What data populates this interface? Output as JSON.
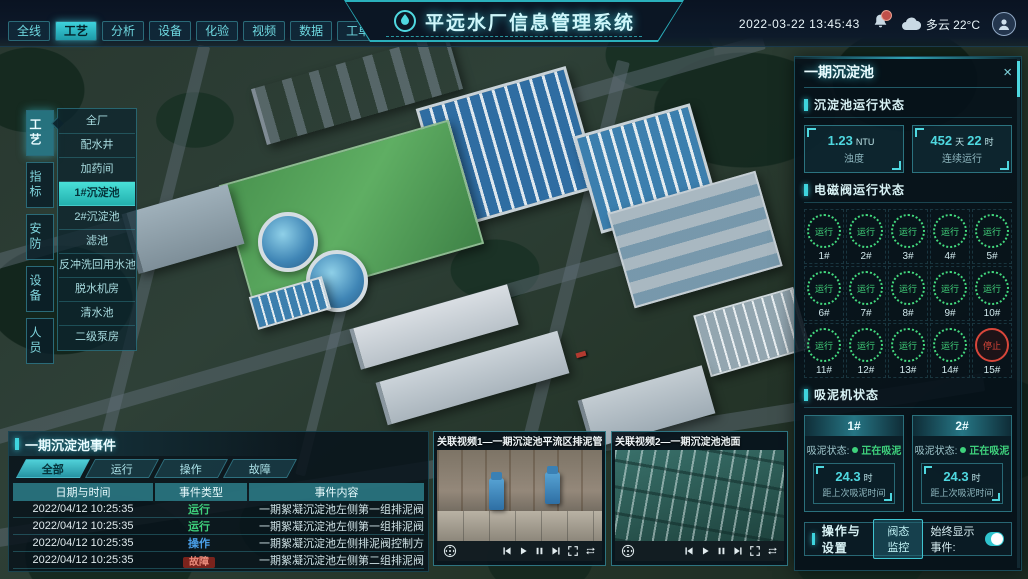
{
  "header": {
    "nav": [
      {
        "label": "全线"
      },
      {
        "label": "工艺",
        "state": "active"
      },
      {
        "label": "分析"
      },
      {
        "label": "设备"
      },
      {
        "label": "化验"
      },
      {
        "label": "视频"
      },
      {
        "label": "数据"
      },
      {
        "label": "工单"
      },
      {
        "label": "系统"
      }
    ],
    "title": "平远水厂信息管理系统",
    "datetime": "2022-03-22 13:45:43",
    "weather": "多云 22°C"
  },
  "sidebar": {
    "tabs": [
      {
        "label": "工艺",
        "state": "active"
      },
      {
        "label": "指标"
      },
      {
        "label": "安防"
      },
      {
        "label": "设备"
      },
      {
        "label": "人员"
      }
    ],
    "menu": [
      {
        "label": "全厂"
      },
      {
        "label": "配水井"
      },
      {
        "label": "加药间"
      },
      {
        "label": "1#沉淀池",
        "state": "active"
      },
      {
        "label": "2#沉淀池"
      },
      {
        "label": "滤池"
      },
      {
        "label": "反冲洗回用水池"
      },
      {
        "label": "脱水机房"
      },
      {
        "label": "清水池"
      },
      {
        "label": "二级泵房"
      }
    ]
  },
  "right_panel": {
    "title": "一期沉淀池",
    "close": "×",
    "running_status": {
      "section_title": "沉淀池运行状态",
      "stats": [
        {
          "v1": "1.23",
          "u1": "NTU",
          "v2": "",
          "u2": "",
          "label": "浊度"
        },
        {
          "v1": "452",
          "u1": "天",
          "v2": "22",
          "u2": "时",
          "label": "连续运行"
        }
      ]
    },
    "valves": {
      "section_title": "电磁阀运行状态",
      "items": [
        {
          "id": "1#",
          "status": "运行",
          "state": "run"
        },
        {
          "id": "2#",
          "status": "运行",
          "state": "run"
        },
        {
          "id": "3#",
          "status": "运行",
          "state": "run"
        },
        {
          "id": "4#",
          "status": "运行",
          "state": "run"
        },
        {
          "id": "5#",
          "status": "运行",
          "state": "run"
        },
        {
          "id": "6#",
          "status": "运行",
          "state": "run"
        },
        {
          "id": "7#",
          "status": "运行",
          "state": "run"
        },
        {
          "id": "8#",
          "status": "运行",
          "state": "run"
        },
        {
          "id": "9#",
          "status": "运行",
          "state": "run"
        },
        {
          "id": "10#",
          "status": "运行",
          "state": "run"
        },
        {
          "id": "11#",
          "status": "运行",
          "state": "run"
        },
        {
          "id": "12#",
          "status": "运行",
          "state": "run"
        },
        {
          "id": "13#",
          "status": "运行",
          "state": "run"
        },
        {
          "id": "14#",
          "status": "运行",
          "state": "run"
        },
        {
          "id": "15#",
          "status": "停止",
          "state": "stop"
        }
      ]
    },
    "mud_suction": {
      "section_title": "吸泥机状态",
      "machines": [
        {
          "id": "1#",
          "status_label": "吸泥状态:",
          "status": "正在吸泥",
          "value": "24.3",
          "unit": "时",
          "note": "距上次吸泥时间"
        },
        {
          "id": "2#",
          "status_label": "吸泥状态:",
          "status": "正在吸泥",
          "value": "24.3",
          "unit": "时",
          "note": "距上次吸泥时间"
        }
      ]
    },
    "operations": {
      "section_title": "操作与设置",
      "button": "阀态监控",
      "toggle_label": "始终显示事件:",
      "toggle_on": true
    }
  },
  "events_panel": {
    "title": "一期沉淀池事件",
    "tabs": [
      {
        "label": "全部",
        "state": "active"
      },
      {
        "label": "运行"
      },
      {
        "label": "操作"
      },
      {
        "label": "故障"
      }
    ],
    "columns": [
      "日期与时间",
      "事件类型",
      "事件内容"
    ],
    "rows": [
      {
        "time": "2022/04/12 10:25:35",
        "type": "运行",
        "type_class": "run",
        "content": "一期絮凝沉淀池左侧第一组排泥阀正在排泥"
      },
      {
        "time": "2022/04/12 10:25:35",
        "type": "运行",
        "type_class": "run",
        "content": "一期絮凝沉淀池左侧第一组排泥阀正在排泥"
      },
      {
        "time": "2022/04/12 10:25:35",
        "type": "操作",
        "type_class": "op",
        "content": "一期絮凝沉淀池左侧排泥阀控制方式切换为手动"
      },
      {
        "time": "2022/04/12 10:25:35",
        "type": "故障",
        "type_class": "fault",
        "content": "一期絮凝沉淀池左侧第二组排泥阀启动失败"
      }
    ]
  },
  "videos": [
    {
      "title": "关联视频1—一期沉淀池平流区排泥管廊"
    },
    {
      "title": "关联视频2—一期沉淀池池面"
    }
  ],
  "colors": {
    "accent": "#3fd4de",
    "run_green": "#3ed17c",
    "op_blue": "#4a9fe8",
    "fault_red": "#c8453a"
  }
}
